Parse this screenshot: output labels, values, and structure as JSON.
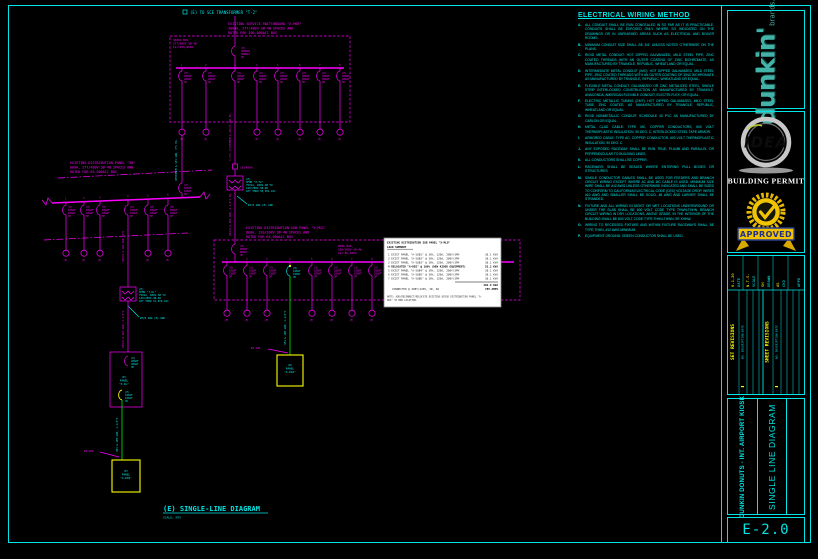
{
  "notes": {
    "title": "ELECTRICAL WIRING METHOD",
    "items": [
      {
        "id": "A.",
        "text": "ALL CONDUIT SHALL BE RUN CONCEALED IN SO FAR AS IT IS PRACTICABLE. CONDUITS SHALL BE EXPOSED ONLY WHERE SO INDICATED ON THE DRAWINGS OR IN UNFINISHED AREAS SUCH AS ELECTRICAL AND BOILER ROOMS."
      },
      {
        "id": "B.",
        "text": "MINIMUM CONDUIT SIZE SHALL BE 3/4\" UNLESS NOTED OTHERWISE ON THE PLANS."
      },
      {
        "id": "C.",
        "text": "RIGID METAL CONDUIT: HOT DIPPED GALVANIZED, MILD STEEL PIPE, ZINC COATED THREADS WITH AN OUTER COATING OF ZINC BICHROMATE, AS MANUFACTURED BY TRIANGLE, REPUBLIC, WHEATLAND OR EQUAL."
      },
      {
        "id": "D.",
        "text": "INTERMEDIATE METAL CONDUIT (IMC): HOT DIPPED GALVANIZED, MILD STEEL PIPE, ZINC COATED THREADS WITH AN OUTER COATING OF ZINC BICHROMATE AS MANUFACTURED BY TRIANGLE, REPUBLIC, WHEATLAND OR EQUAL."
      },
      {
        "id": "E.",
        "text": "FLEXIBLE METAL CONDUIT: GALVANIZED OR ZINC METALIZED STEEL, SINGLE STRIP INTERLOCKED CONSTRUCTION AS MANUFACTURED BY TRIANGLE, ANACONDA, AMERICAN FLEXIBLE CONDUIT, ELECTRI-FLEX, OR EQUAL."
      },
      {
        "id": "F.",
        "text": "ELECTRIC METALLIC TUBING (EMT): HOT DIPPED GALVANIZED, MILD STEEL TUBE, ZINC COATED, AS MANUFACTURED BY TRIANGLE, REPUBLIC, WHEATLAND OR EQUAL."
      },
      {
        "id": "G.",
        "text": "RIGID NONMETALLIC CONDUIT: SCHEDULE 40 PVC AS MANUFACTURED BY CARLON OR EQUAL."
      },
      {
        "id": "H.",
        "text": "METAL CLAD CABLE: TYPE MC, COPPER CONDUCTORS, 600 VOLT THERMOPLASTIC INSULATION, 90 DEG. C, INTERLOCKED STEEL TAPE ARMOR."
      },
      {
        "id": "I.",
        "text": "ARMORED CABLE: TYPE AC, COPPER CONDUCTOR, 600 VOLT THERMOPLASTIC INSULATION, 90 DEG. C."
      },
      {
        "id": "J.",
        "text": "ANY EXPOSED RACEWAY SHALL BE RUN TRUE, PLUMB AND PARALLEL OR PERPENDICULAR TO BUILDING LINES."
      },
      {
        "id": "K.",
        "text": "ALL CONDUCTORS SHALL BE COPPER."
      },
      {
        "id": "L.",
        "text": "RACEWAYS SHALL BE SEALED WHERE ENTERING PULL BOXES OR STRUCTURES."
      },
      {
        "id": "M.",
        "text": "SINGLE CONDUCTOR CABLES SHALL BE USED FOR FEEDERS AND BRANCH CIRCUIT WIRING EXCEPT WHERE AC AND MC CABLE IS USED. MINIMUM SIZE WIRE SHALL BE #12 AWG UNLESS OTHERWISE INDICATED AND SHALL BE SIZED TO CONFORM TO CALIFORNIA ELECTRICAL CODE (CEC) VOLTAGE DROP. WIRES #10 AWG AND SMALLER SHALL BE SOLID, #8 AWG AND LARGER SHALL BE STRANDED."
      },
      {
        "id": "N.",
        "text": "FIXTURE AND ALL WIRING IN MOIST OR WET LOCATIONS UNDERGROUND OR UNDER THE SLAB SHALL BE 600 VOLT CODE TYPE THWN-THHN. BRANCH CIRCUIT WIRING IN DRY LOCATIONS, ABOVE GRADE, IN THE INTERIOR OF THE BUILDING SHALL BE 600 VOLT CODE TYPE THHN-THWN OR XHHW."
      },
      {
        "id": "O.",
        "text": "WIRING TO RECESSED FIXTURE AND WITHIN FIXTURE RACEWAYS SHALL BE TYPE THHN, #12 AWG MINIMUM."
      },
      {
        "id": "P.",
        "text": "EQUIPMENT GROUND: GREEN CONDUCTOR SHALL BE USED."
      }
    ]
  },
  "titleblock": {
    "brand": "dunkin'",
    "brand_sub": "brands...",
    "idea": "IDEA",
    "permit": "BUILDING PERMIT",
    "approved": "APPROVED",
    "fields": [
      {
        "label": "DATE",
        "value": "6-1-20"
      },
      {
        "label": "SCALE",
        "value": "N.T.S."
      },
      {
        "label": "DRAWN",
        "value": "SH"
      },
      {
        "label": "CKD",
        "value": "AS"
      },
      {
        "label": "APPD",
        "value": ""
      }
    ],
    "set_revisions": "SET REVISIONS",
    "sheet_revisions": "SHEET REVISIONS",
    "rev_header": "NO.  DESCRIPTION  DATE",
    "project": "DUNKIN DONUTS - INT. AIRPORT KIOSK",
    "sheet_title": "SINGLE LINE DIAGRAM",
    "sheet_no": "E-2.0"
  },
  "diagram": {
    "feed_label": "(E) TO SCE TRANSFORMER \"T-2\"",
    "meter_tag": "(E)",
    "msb": {
      "title1": "EXISTING SERVICE SWITCHBOARD \"X-MSB\"",
      "title2": "3000A, 277/480V-3Ø-4W SPACES AND",
      "title3": "RATED FOR 100,000AIC BUS",
      "bus1": "3000A BUS,",
      "bus2": "277/480V-3Ø-4W",
      "bus3": "Isc=100,000A",
      "main": [
        "(E)",
        "3000AF",
        "3000AT",
        "3P"
      ],
      "positions": [
        "1",
        "2",
        "3",
        "4",
        "5",
        "6",
        "7",
        "8"
      ]
    },
    "bkr400": [
      "(E)",
      "400AF",
      "400AT",
      "3P"
    ],
    "bkr100": [
      "(E)",
      "100AF",
      "100AT",
      "3P"
    ],
    "db": {
      "title1": "EXISTING DISTRIBUTION PANEL \"DB\"",
      "title2": "800A, 277/480V-3Ø-4W SPACES AND",
      "title3": "RATED FOR 65,000AIC BUS",
      "positions": [
        "1",
        "2",
        "3",
        "4",
        "5",
        "6"
      ]
    },
    "dbfeed": "3#350MCM & 1#1 GRD, 3\"C EA.",
    "feeder1": "3-3\"C.(3)500MCM & 1#3/0 GRD EA.",
    "feeder2": "4#4/0 & 1#4 GRD, 2-1/2\"C EA.",
    "feeder3": "3#4/0 & 1#4 GRD, 2\"C",
    "feeder4": "4#4/0 & 1#4 GRD, 2-1/2\"C",
    "disc1": "(E)400A",
    "xfmr1": [
      "(E)",
      "XFMR \"X-T2\"",
      "75kVA, 480V-3Ø TO",
      "120/208V-3Ø-4W",
      "LET THRU 30,504 AIC"
    ],
    "xfmr2": [
      "(E)",
      "XFMR \"T-DL\"",
      "75kVA, 480V-3Ø TO",
      "120/208V-3Ø-4W",
      "LET THRU 31,876 AIC"
    ],
    "grd1": "#3/0 AWG (E) GRD",
    "grd2": "#4 GRD",
    "sub": {
      "title1": "EXISTING DISTRIBUTION SUB PANEL \"X-MLO\"",
      "title2": "800A, 120/208V-3Ø-4W SPACES AND",
      "title3": "RATED FOR 65,000AIC BUS",
      "bus1": "800A BUS,",
      "bus2": "120/208V-3Ø-4W",
      "bus3": "Isc=65,000A",
      "main": [
        "(E)",
        "800AF",
        "800AT",
        "3P"
      ],
      "positions": [
        "1",
        "2",
        "3",
        "4",
        "5",
        "6",
        "7",
        "8"
      ]
    },
    "rbkr": [
      "(R)",
      "100AF",
      "100AT",
      "3P"
    ],
    "grn1": "3#4 & 1#8 GRD, 1-1/4\"C",
    "panel_dl": [
      "(E)",
      "PANEL",
      "\"X-DL\""
    ],
    "panel_e": [
      "(E)",
      "PANEL",
      "\"A-DD2\""
    ],
    "panel_r": [
      "(R)",
      "PANEL",
      "\"A-DD2\""
    ],
    "title": "(E) SINGLE-LINE DIAGRAM",
    "scale": "SCALE: NTS"
  },
  "schedule": {
    "title": "EXISTING DISTRIBUTION SUB PANEL \"X-MLO\"",
    "subtitle": "LOAD SUMMARY",
    "rows": [
      {
        "desc": "1   EXIST PANEL \"A-SUB1\" @ 30%, 120A, 208Y/3PH",
        "val": "38.1 KVA"
      },
      {
        "desc": "2   EXIST PANEL \"A-SUB2\" @ 30%, 120A, 208Y/3PH",
        "val": "38.1 KVA"
      },
      {
        "desc": "3   EXIST PANEL \"A-SUB3\" @ 30%, 120A, 208Y/3PH",
        "val": "38.1 KVA"
      },
      {
        "desc": "4   RELOCATED \"A-DD2\" @ 100% (NEW KIOSK EQUIPMENT)",
        "val": "53.2 KVA"
      },
      {
        "desc": "5   EXIST PANEL \"A-SUB4\" @ 30%, 120A, 208Y/3PH",
        "val": "38.1 KVA"
      },
      {
        "desc": "6   EXIST PANEL \"A-SUB5\" @ 30%, 120A, 208Y/3PH",
        "val": "38.1 KVA"
      },
      {
        "desc": "7   EXIST PANEL \"A-SUB6\" @ 30%, 120A, 208Y/3PH",
        "val": "38.1 KVA"
      }
    ],
    "subtotal": "282.9 KVA",
    "amps_label": "CONNECTED @ 208Y/120V, 3Ø, 4W",
    "amps": "785 AMPS",
    "note1": "NOTE: ADD/RECONNECT/RELOCATE EXISTING KIOSK DISTRIBUTION PANEL \"A-",
    "note2": "DD2\" TO NEW LOCATION."
  }
}
